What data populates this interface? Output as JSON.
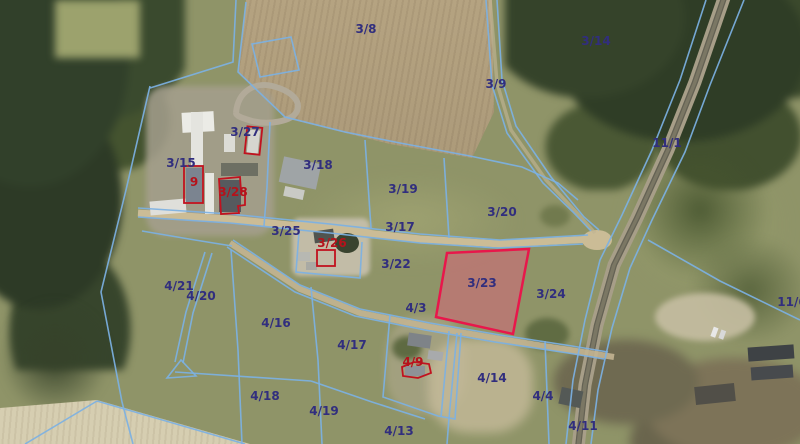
{
  "selected_parcel": "3/23",
  "labels": [
    {
      "label": "3/8",
      "x": 366,
      "y": 29,
      "color": "navy"
    },
    {
      "label": "3/14",
      "x": 596,
      "y": 41,
      "color": "navy"
    },
    {
      "label": "3/9",
      "x": 496,
      "y": 84,
      "color": "navy"
    },
    {
      "label": "3/27",
      "x": 245,
      "y": 132,
      "color": "navy"
    },
    {
      "label": "11/1",
      "x": 667,
      "y": 143,
      "color": "navy"
    },
    {
      "label": "3/15",
      "x": 181,
      "y": 163,
      "color": "navy"
    },
    {
      "label": "3/18",
      "x": 318,
      "y": 165,
      "color": "navy"
    },
    {
      "label": "9",
      "x": 194,
      "y": 182,
      "color": "red"
    },
    {
      "label": "3/19",
      "x": 403,
      "y": 189,
      "color": "navy"
    },
    {
      "label": "3/28",
      "x": 233,
      "y": 192,
      "color": "red"
    },
    {
      "label": "3/20",
      "x": 502,
      "y": 212,
      "color": "navy"
    },
    {
      "label": "3/17",
      "x": 400,
      "y": 227,
      "color": "navy"
    },
    {
      "label": "3/25",
      "x": 286,
      "y": 231,
      "color": "navy"
    },
    {
      "label": "3/26",
      "x": 332,
      "y": 243,
      "color": "red"
    },
    {
      "label": "3/22",
      "x": 396,
      "y": 264,
      "color": "navy"
    },
    {
      "label": "3/23",
      "x": 482,
      "y": 283,
      "color": "navy"
    },
    {
      "label": "3/24",
      "x": 551,
      "y": 294,
      "color": "navy"
    },
    {
      "label": "4/21",
      "x": 179,
      "y": 286,
      "color": "navy"
    },
    {
      "label": "4/20",
      "x": 201,
      "y": 296,
      "color": "navy"
    },
    {
      "label": "11/6",
      "x": 792,
      "y": 302,
      "color": "navy"
    },
    {
      "label": "4/3",
      "x": 416,
      "y": 308,
      "color": "navy"
    },
    {
      "label": "4/16",
      "x": 276,
      "y": 323,
      "color": "navy"
    },
    {
      "label": "4/17",
      "x": 352,
      "y": 345,
      "color": "navy"
    },
    {
      "label": "4/9",
      "x": 413,
      "y": 362,
      "color": "red"
    },
    {
      "label": "4/14",
      "x": 492,
      "y": 378,
      "color": "navy"
    },
    {
      "label": "4/4",
      "x": 543,
      "y": 396,
      "color": "navy"
    },
    {
      "label": "4/18",
      "x": 265,
      "y": 396,
      "color": "navy"
    },
    {
      "label": "4/19",
      "x": 324,
      "y": 411,
      "color": "navy"
    },
    {
      "label": "4/13",
      "x": 399,
      "y": 431,
      "color": "navy"
    },
    {
      "label": "4/11",
      "x": 583,
      "y": 426,
      "color": "navy"
    }
  ],
  "colors": {
    "boundary-blue": "#7cb1e3",
    "label-navy": "#312e7e",
    "label-red": "#b5121b",
    "selected-border": "#e8174b",
    "selected-fill": "rgba(219,97,124,0.5)",
    "building-outline-red": "#c1121f"
  }
}
